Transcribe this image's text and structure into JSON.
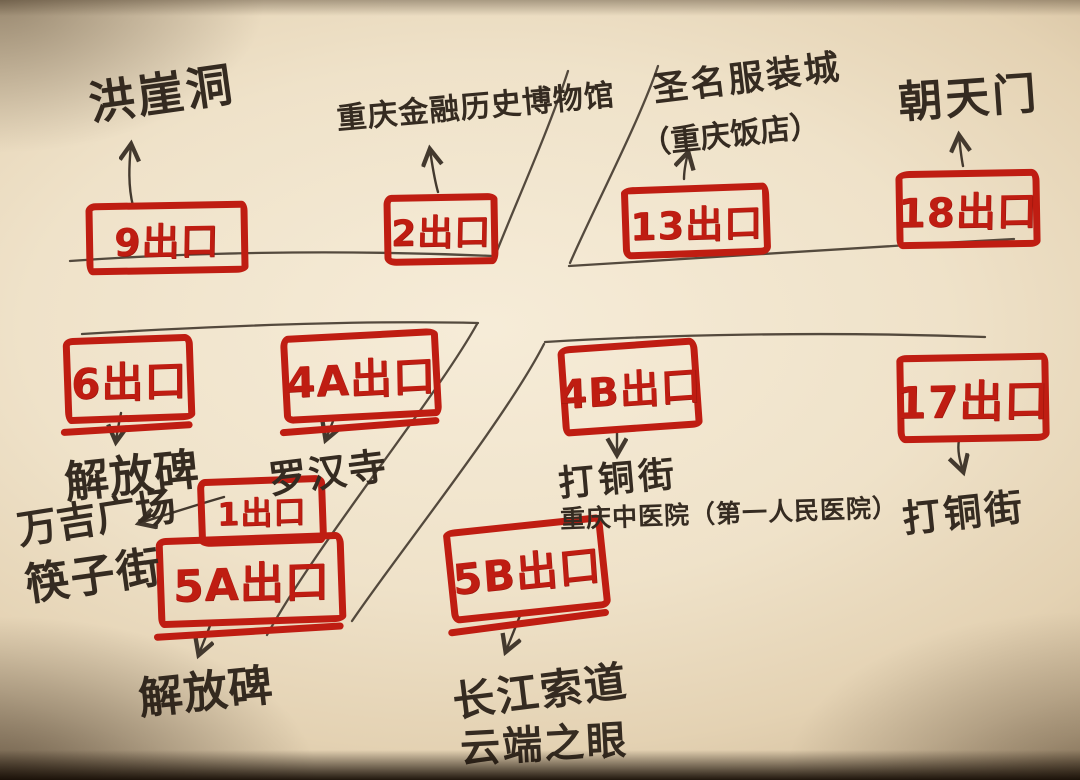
{
  "document_type": "hand-drawn subway station exit map on paper",
  "colors": {
    "marker_red": "#bf1d12",
    "pen_ink": "#43392e",
    "paper": "#efe2c9"
  },
  "exits": {
    "e9": {
      "label": "9出口",
      "destinations": [
        "洪崖洞"
      ]
    },
    "e2": {
      "label": "2出口",
      "destinations": [
        "重庆金融历史博物馆"
      ]
    },
    "e13": {
      "label": "13出口",
      "destinations": [
        "圣名服装城",
        "（重庆饭店）"
      ]
    },
    "e18": {
      "label": "18出口",
      "destinations": [
        "朝天门"
      ]
    },
    "e6": {
      "label": "6出口",
      "destinations": [
        "解放碑"
      ]
    },
    "e4a": {
      "label": "4A出口",
      "destinations": [
        "罗汉寺"
      ]
    },
    "e4b": {
      "label": "4B出口",
      "destinations": [
        "打铜街",
        "重庆中医院（第一人民医院）"
      ]
    },
    "e17": {
      "label": "17出口",
      "destinations": [
        "打铜街"
      ]
    },
    "e1": {
      "label": "1出口",
      "destinations": [
        "万吉广场",
        "筷子街"
      ]
    },
    "e5a": {
      "label": "5A出口",
      "destinations": [
        "解放碑"
      ]
    },
    "e5b": {
      "label": "5B出口",
      "destinations": [
        "长江索道",
        "云端之眼"
      ]
    }
  }
}
